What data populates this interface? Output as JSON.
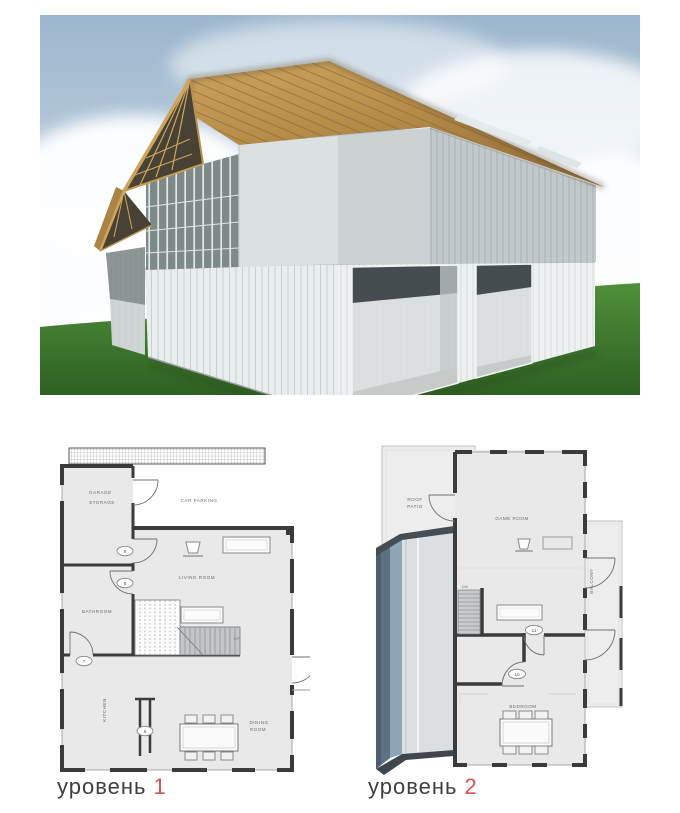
{
  "figure": {
    "type": "architectural-presentation",
    "render_subject": "two-storey shipping-container house with wooden gable roof on grass"
  },
  "colors": {
    "sky": "#a9c2d6",
    "grass": "#3f7c2e",
    "roof_wood": "#b58b48",
    "container_white": "#eef1f1",
    "plan_wall": "#3b3b3b",
    "plan_room_fill": "#e9e9e9",
    "blue_roof_face": "#5d7185",
    "caption_text_color": "#3f3f3f",
    "caption_number_color": "#d65252"
  },
  "plan1": {
    "caption_text": "уровень",
    "caption_number": "1",
    "label_garage_1": "GARAGE",
    "label_garage_2": "STORAGE",
    "label_car_parking": "CAR PARKING",
    "label_living_room": "LIVING ROOM",
    "label_bathroom": "BATHROOM",
    "label_kitchen": "KITCHEN",
    "label_dining_1": "DINING",
    "label_dining_2": "ROOM",
    "label_up": "UP",
    "tag_9": "9",
    "tag_8": "8",
    "tag_7": "7",
    "tag_6": "6"
  },
  "plan2": {
    "caption_text": "уровень",
    "caption_number": "2",
    "label_roof_1": "ROOF",
    "label_roof_2": "PATIO",
    "label_game_room": "GAME ROOM",
    "label_dn": "DN",
    "label_balcony": "BALCONY",
    "label_bedroom": "BEDROOM",
    "tag_11": "11",
    "tag_10": "10"
  }
}
